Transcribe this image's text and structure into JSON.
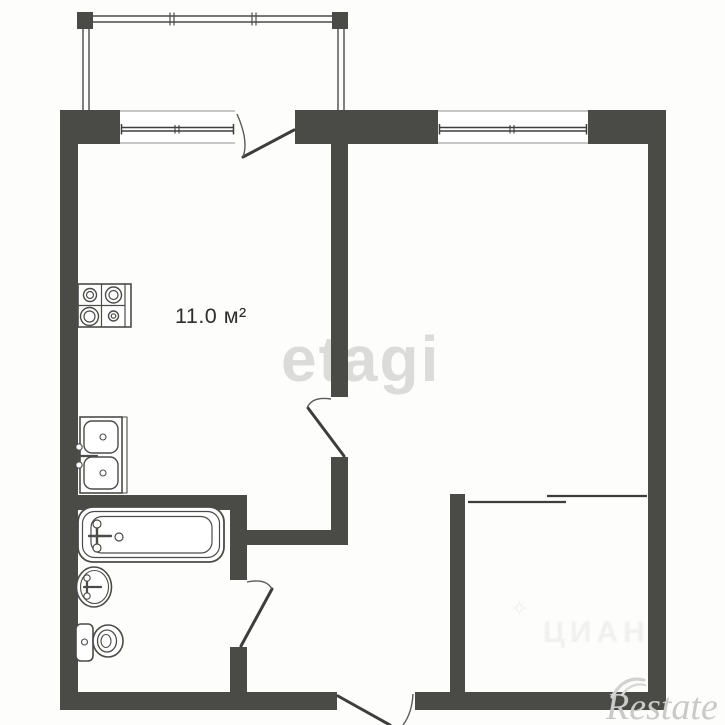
{
  "title": "Apartment floor plan",
  "area_label": "11.0 м²",
  "watermarks": {
    "etagi": "etagi",
    "cian": "ЦИАН",
    "cian_star": "✧",
    "restate": "Restate"
  },
  "colors": {
    "bg": "#fdfdfc",
    "wall": "#4a4a47",
    "line": "#4b4b49",
    "leaf": "#3d3d3b",
    "edge": "#8f8f8d",
    "label": "#2e2e2c",
    "wm-etagi": "#dbdbd9",
    "wm-cian": "#ededeb",
    "wm-restate": "#c9c9c7"
  }
}
